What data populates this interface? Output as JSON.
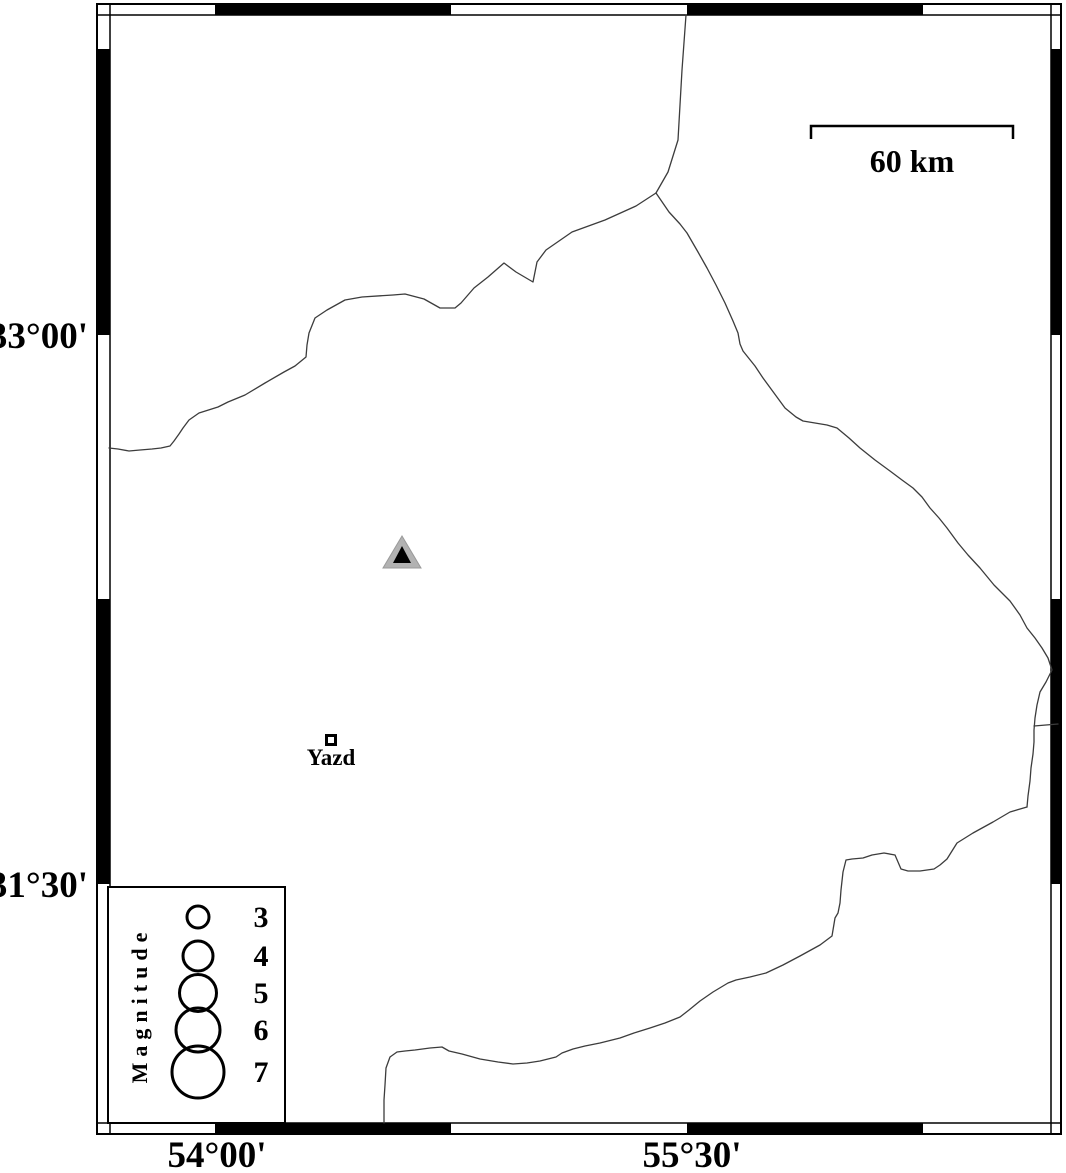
{
  "figure": {
    "type": "seismicity-map",
    "background": "#ffffff",
    "frame_color": "#000000"
  },
  "labels": {
    "lat": [
      {
        "text": "33°00'"
      },
      {
        "text": "31°30'"
      }
    ],
    "lon": [
      {
        "text": "54°00'"
      },
      {
        "text": "55°30'"
      }
    ]
  },
  "scale_bar": {
    "label": "60 km",
    "x1": 811,
    "x2": 1013,
    "y_top": 126,
    "tick_h": 13
  },
  "markers": {
    "station": {
      "name": "station-triangle",
      "x": 402,
      "y": 553,
      "outer_color": "#b2b2b2",
      "inner_color": "#000000"
    },
    "city": {
      "label": "Yazd",
      "x": 331,
      "y": 740
    }
  },
  "legend": {
    "title": "Magnitude",
    "box": {
      "x": 108,
      "y": 887,
      "w": 177,
      "h": 236
    },
    "circle_x": 198,
    "number_x": 261,
    "entries": [
      {
        "label": "3",
        "cy": 917,
        "r": 11
      },
      {
        "label": "4",
        "cy": 956,
        "r": 15
      },
      {
        "label": "5",
        "cy": 993,
        "r": 18.5
      },
      {
        "label": "6",
        "cy": 1030,
        "r": 22
      },
      {
        "label": "7",
        "cy": 1072,
        "r": 26
      }
    ]
  },
  "frame": {
    "outer": {
      "x": 97,
      "y": 4,
      "w": 964,
      "h": 1130
    },
    "inner": {
      "x": 110,
      "y": 15,
      "x2": 1051,
      "y2": 1123
    },
    "black_x": [
      [
        215,
        451
      ],
      [
        687,
        923
      ]
    ],
    "black_y": [
      [
        49,
        335
      ],
      [
        599,
        884
      ]
    ]
  },
  "boundaries": {
    "color": "#3c3c3c",
    "width": 1.3,
    "paths": [
      [
        [
          686,
          15
        ],
        [
          682,
          70
        ],
        [
          678,
          140
        ],
        [
          668,
          172
        ],
        [
          656,
          193
        ]
      ],
      [
        [
          656,
          193
        ],
        [
          636,
          206
        ],
        [
          605,
          220
        ],
        [
          572,
          232
        ],
        [
          546,
          250
        ],
        [
          537,
          262
        ],
        [
          533,
          282
        ],
        [
          516,
          272
        ],
        [
          504,
          263
        ],
        [
          488,
          277
        ],
        [
          474,
          288
        ],
        [
          461,
          303
        ],
        [
          455,
          308
        ],
        [
          440,
          308
        ],
        [
          424,
          299
        ],
        [
          405,
          294
        ],
        [
          393,
          295
        ],
        [
          362,
          297
        ],
        [
          345,
          300
        ],
        [
          327,
          310
        ],
        [
          315,
          318
        ],
        [
          309,
          333
        ],
        [
          307,
          345
        ],
        [
          306,
          357
        ],
        [
          295,
          366
        ],
        [
          284,
          372
        ],
        [
          265,
          383
        ],
        [
          245,
          395
        ],
        [
          228,
          402
        ],
        [
          218,
          407
        ],
        [
          199,
          413
        ],
        [
          189,
          420
        ],
        [
          183,
          428
        ],
        [
          179,
          434
        ],
        [
          174,
          441
        ],
        [
          170,
          446
        ],
        [
          161,
          448
        ],
        [
          152,
          449
        ],
        [
          140,
          450
        ],
        [
          129,
          451
        ],
        [
          118,
          449
        ],
        [
          109,
          448
        ]
      ],
      [
        [
          656,
          193
        ],
        [
          669,
          212
        ],
        [
          680,
          224
        ],
        [
          687,
          233
        ],
        [
          698,
          252
        ],
        [
          707,
          268
        ],
        [
          716,
          285
        ],
        [
          725,
          303
        ],
        [
          733,
          321
        ],
        [
          738,
          333
        ],
        [
          740,
          344
        ],
        [
          743,
          351
        ],
        [
          755,
          366
        ],
        [
          763,
          378
        ],
        [
          774,
          393
        ],
        [
          785,
          408
        ],
        [
          796,
          417
        ],
        [
          803,
          421
        ],
        [
          815,
          423
        ],
        [
          827,
          425
        ],
        [
          837,
          428
        ],
        [
          849,
          438
        ],
        [
          860,
          448
        ],
        [
          875,
          460
        ],
        [
          890,
          471
        ],
        [
          902,
          480
        ],
        [
          913,
          488
        ],
        [
          922,
          497
        ],
        [
          930,
          508
        ],
        [
          939,
          518
        ],
        [
          947,
          528
        ],
        [
          958,
          543
        ],
        [
          968,
          555
        ],
        [
          980,
          568
        ],
        [
          994,
          585
        ],
        [
          1010,
          601
        ],
        [
          1020,
          615
        ],
        [
          1027,
          628
        ],
        [
          1035,
          638
        ],
        [
          1042,
          648
        ],
        [
          1048,
          658
        ],
        [
          1052,
          670
        ],
        [
          1046,
          682
        ],
        [
          1040,
          692
        ],
        [
          1037,
          705
        ],
        [
          1035,
          718
        ],
        [
          1034,
          730
        ],
        [
          1034,
          742
        ],
        [
          1033,
          754
        ],
        [
          1031,
          768
        ],
        [
          1030,
          781
        ],
        [
          1028,
          796
        ],
        [
          1027,
          807
        ]
      ],
      [
        [
          1034,
          726
        ],
        [
          1046,
          725
        ],
        [
          1058,
          724
        ]
      ],
      [
        [
          1027,
          807
        ],
        [
          1010,
          812
        ],
        [
          993,
          822
        ],
        [
          973,
          833
        ],
        [
          957,
          843
        ],
        [
          947,
          859
        ],
        [
          940,
          865
        ],
        [
          934,
          869
        ],
        [
          920,
          871
        ],
        [
          908,
          871
        ],
        [
          901,
          869
        ],
        [
          895,
          855
        ],
        [
          884,
          853
        ],
        [
          872,
          855
        ],
        [
          863,
          858
        ],
        [
          852,
          859
        ],
        [
          846,
          860
        ],
        [
          843,
          872
        ],
        [
          841,
          890
        ],
        [
          840,
          903
        ],
        [
          838,
          913
        ],
        [
          835,
          918
        ],
        [
          832,
          936
        ],
        [
          820,
          945
        ],
        [
          800,
          956
        ],
        [
          783,
          965
        ],
        [
          766,
          973
        ],
        [
          750,
          977
        ],
        [
          736,
          980
        ],
        [
          728,
          983
        ],
        [
          713,
          992
        ],
        [
          700,
          1001
        ],
        [
          689,
          1010
        ],
        [
          680,
          1017
        ],
        [
          665,
          1023
        ],
        [
          650,
          1028
        ],
        [
          634,
          1033
        ],
        [
          620,
          1038
        ],
        [
          600,
          1043
        ],
        [
          585,
          1046
        ],
        [
          573,
          1049
        ],
        [
          562,
          1053
        ],
        [
          556,
          1057
        ],
        [
          540,
          1061
        ],
        [
          527,
          1063
        ],
        [
          513,
          1064
        ],
        [
          498,
          1062
        ],
        [
          480,
          1059
        ],
        [
          462,
          1054
        ],
        [
          449,
          1051
        ],
        [
          442,
          1047
        ],
        [
          430,
          1048
        ],
        [
          415,
          1050
        ],
        [
          405,
          1051
        ],
        [
          397,
          1052
        ],
        [
          390,
          1057
        ],
        [
          386,
          1068
        ],
        [
          385,
          1085
        ],
        [
          384,
          1100
        ],
        [
          384,
          1123
        ]
      ]
    ]
  }
}
